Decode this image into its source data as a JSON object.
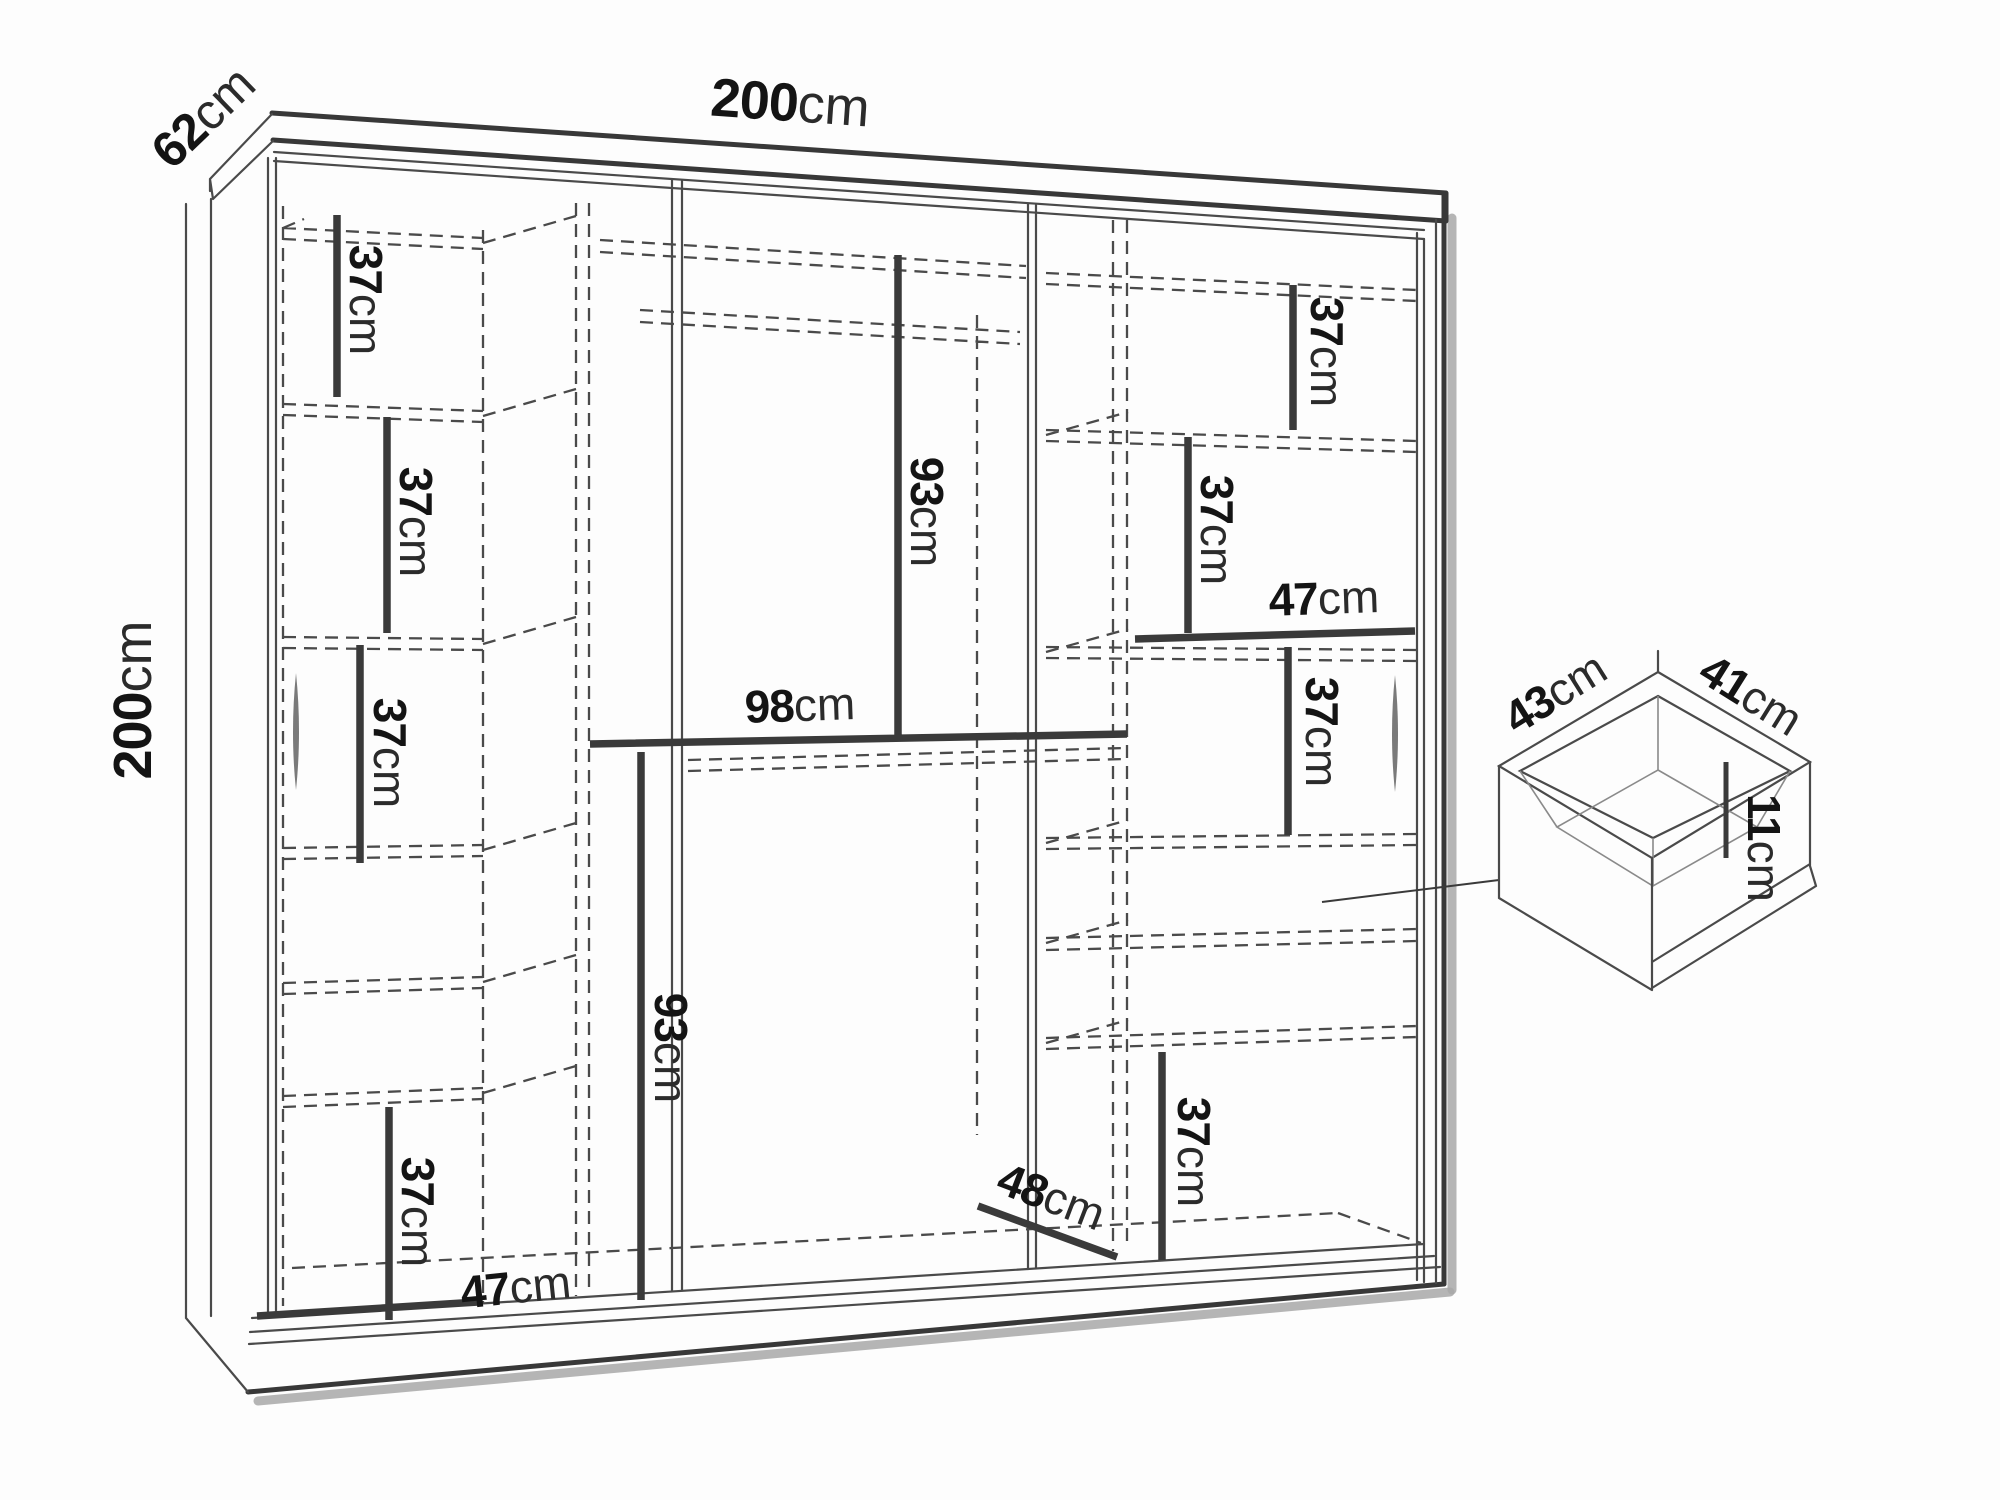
{
  "figure": {
    "kind": "furniture-dimension-diagram",
    "main_view": "wardrobe-front-view",
    "detail_view": "drawer-isometric-view"
  },
  "colors": {
    "background": "#fdfdfd",
    "line": "#3a3a3a",
    "dashed_line": "#4a4a4a",
    "text": "#141414",
    "shadow": "#a8a8a8"
  },
  "dims": {
    "width": {
      "num": "200",
      "unit": "cm"
    },
    "depth": {
      "num": "62",
      "unit": "cm"
    },
    "height": {
      "num": "200",
      "unit": "cm"
    },
    "shelf_left_1": {
      "num": "37",
      "unit": "cm"
    },
    "shelf_left_2": {
      "num": "37",
      "unit": "cm"
    },
    "shelf_left_3": {
      "num": "37",
      "unit": "cm"
    },
    "shelf_left_4": {
      "num": "37",
      "unit": "cm"
    },
    "bottom_left_width": {
      "num": "47",
      "unit": "cm"
    },
    "hanging_top": {
      "num": "93",
      "unit": "cm"
    },
    "middle_width": {
      "num": "98",
      "unit": "cm"
    },
    "hanging_bottom": {
      "num": "93",
      "unit": "cm"
    },
    "shelf_right_1": {
      "num": "37",
      "unit": "cm"
    },
    "shelf_right_2": {
      "num": "37",
      "unit": "cm"
    },
    "right_width": {
      "num": "47",
      "unit": "cm"
    },
    "shelf_right_3": {
      "num": "37",
      "unit": "cm"
    },
    "shelf_right_4": {
      "num": "37",
      "unit": "cm"
    },
    "bottom_depth": {
      "num": "48",
      "unit": "cm"
    },
    "drawer_width": {
      "num": "43",
      "unit": "cm"
    },
    "drawer_depth": {
      "num": "41",
      "unit": "cm"
    },
    "drawer_height": {
      "num": "11",
      "unit": "cm"
    }
  }
}
